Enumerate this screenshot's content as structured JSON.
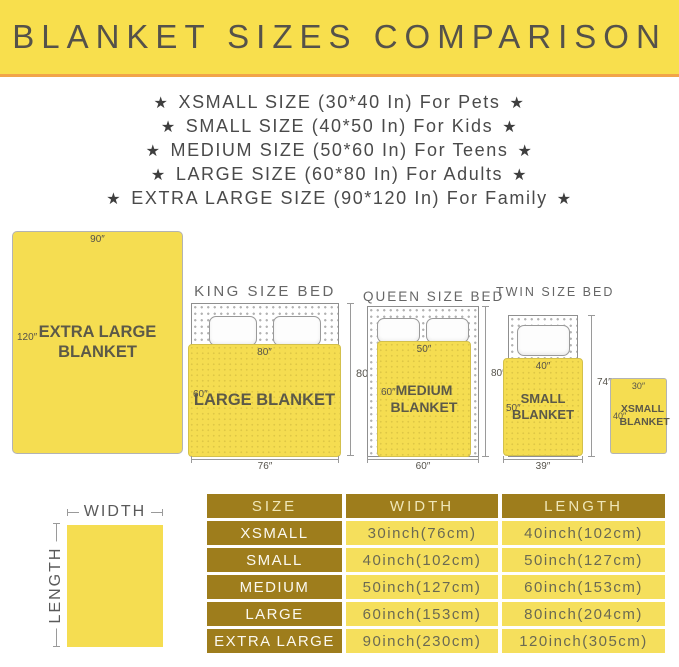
{
  "icons": {
    "star": "★"
  },
  "header": {
    "title": "BLANKET SIZES COMPARISON"
  },
  "size_list": {
    "items": [
      "XSMALL SIZE (30*40 In) For Pets",
      "SMALL SIZE (40*50 In) For Kids",
      "MEDIUM SIZE (50*60 In) For Teens",
      "LARGE SIZE (60*80 In) For Adults",
      "EXTRA LARGE SIZE (90*120 In) For Family"
    ]
  },
  "diagram": {
    "extra_large_blanket": {
      "name": "EXTRA LARGE BLANKET",
      "top_dim": "90″",
      "side_dim": "120″"
    },
    "king_bed": {
      "title": "KING SIZE BED",
      "blanket_name": "LARGE BLANKET",
      "blanket_top_dim": "80″",
      "blanket_side_dim": "60″",
      "bed_height_dim": "80″",
      "bed_width_dim": "76″"
    },
    "queen_bed": {
      "title": "QUEEN SIZE BED",
      "blanket_name": "MEDIUM BLANKET",
      "blanket_top_dim": "50″",
      "blanket_side_dim": "60″",
      "bed_height_dim": "80″",
      "bed_width_dim": "60″"
    },
    "twin_bed": {
      "title": "TWIN SIZE BED",
      "blanket_name": "SMALL BLANKET",
      "blanket_top_dim": "40″",
      "blanket_side_dim": "50″",
      "bed_height_dim": "74″",
      "bed_width_dim": "39″"
    },
    "xsmall_blanket": {
      "name": "XSMALL BLANKET",
      "top_dim": "30″",
      "side_dim": "40″"
    },
    "legend": {
      "width_label": "WIDTH",
      "length_label": "LENGTH"
    }
  },
  "table": {
    "headers": [
      "SIZE",
      "WIDTH",
      "LENGTH"
    ],
    "rows": [
      {
        "size": "XSMALL",
        "width": "30inch(76cm)",
        "length": "40inch(102cm)"
      },
      {
        "size": "SMALL",
        "width": "40inch(102cm)",
        "length": "50inch(127cm)"
      },
      {
        "size": "MEDIUM",
        "width": "50inch(127cm)",
        "length": "60inch(153cm)"
      },
      {
        "size": "LARGE",
        "width": "60inch(153cm)",
        "length": "80inch(204cm)"
      },
      {
        "size": "EXTRA LARGE",
        "width": "90inch(230cm)",
        "length": "120inch(305cm)"
      }
    ]
  },
  "colors": {
    "banner_yellow": "#F8DF4D",
    "banner_accent": "#F2A449",
    "blanket_yellow": "#F5DD51",
    "table_gold": "#9E7D1C",
    "table_cell_yellow": "#F5DF5C",
    "dark_text": "#55524A",
    "list_text": "#4A4A4A"
  }
}
